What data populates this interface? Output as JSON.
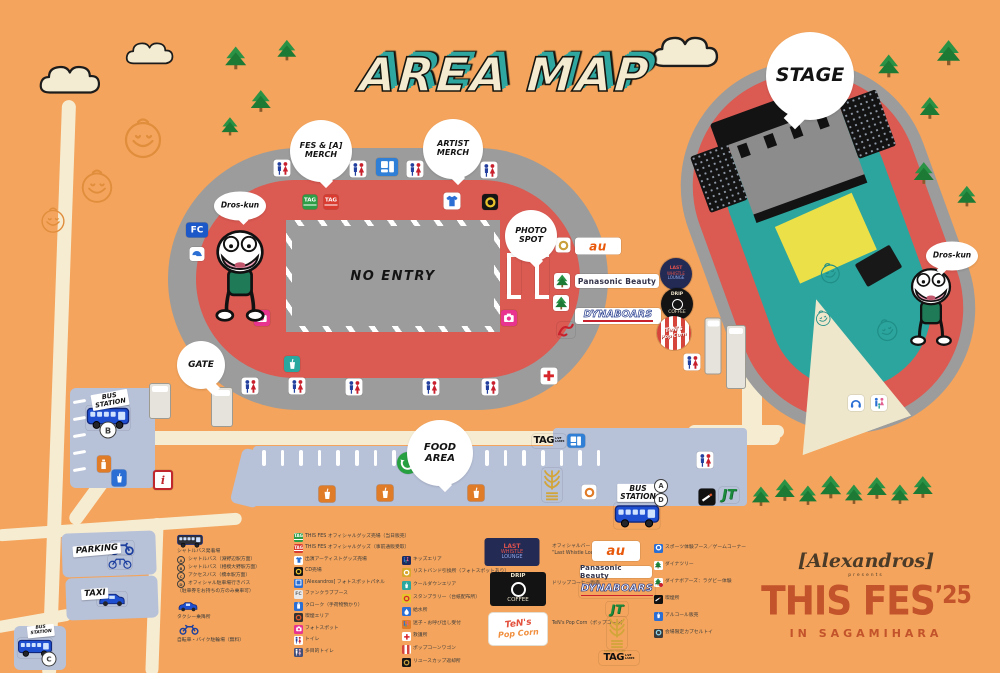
{
  "title": "AREA MAP",
  "colors": {
    "background": "#f4a45c",
    "track_gray": "#9c9c9c",
    "ring_red": "#db5a52",
    "field_teal": "#2ca59e",
    "cream": "#f6ecd2",
    "strip_blue": "#b7c1d8",
    "brand_rust": "#c2532b",
    "title_teal": "#2fa7a0",
    "bus_blue": "#1e4fd0",
    "tree_green": "#1c7a35"
  },
  "brand": {
    "artist": "[Alexandros]",
    "presents": "presents",
    "title": "THIS FES",
    "year": "’25",
    "location": "IN SAGAMIHARA"
  },
  "map": {
    "no_entry": "NO ENTRY",
    "logos": {
      "au": "au",
      "panasonic": "Panasonic Beauty",
      "dynaboars": "DYNABOARS",
      "jt": "JT",
      "fc": "FC",
      "info": "i",
      "tag_main": "TAG",
      "tag_sub": [
        "LIVE",
        "LANES"
      ],
      "tag_mark": "TAG",
      "spring_valley": "SPRING VALLEY"
    },
    "bubbles": [
      {
        "id": "fes-merch",
        "lines": [
          "FES & [A]",
          "MERCH"
        ],
        "x": 321,
        "y": 151,
        "d": 62,
        "fs": 8,
        "tail": "b"
      },
      {
        "id": "artist-merch",
        "lines": [
          "ARTIST",
          "MERCH"
        ],
        "x": 453,
        "y": 149,
        "d": 60,
        "fs": 8,
        "tail": "b"
      },
      {
        "id": "photo-spot",
        "lines": [
          "PHOTO",
          "SPOT"
        ],
        "x": 531,
        "y": 236,
        "d": 52,
        "fs": 8,
        "tail": "b"
      },
      {
        "id": "gate",
        "lines": [
          "GATE"
        ],
        "x": 201,
        "y": 365,
        "d": 48,
        "fs": 9,
        "tail": "br"
      },
      {
        "id": "food-area",
        "lines": [
          "FOOD",
          "AREA"
        ],
        "x": 440,
        "y": 453,
        "d": 66,
        "fs": 10,
        "tail": "b"
      },
      {
        "id": "stage",
        "lines": [
          "STAGE"
        ],
        "x": 810,
        "y": 76,
        "d": 88,
        "fs": 19,
        "tail": "bl"
      },
      {
        "id": "dros-kun-1",
        "lines": [
          "Dros-kun"
        ],
        "x": 240,
        "y": 206,
        "d": 52,
        "fs": 7.5,
        "tail": "b",
        "ell": true
      },
      {
        "id": "dros-kun-2",
        "lines": [
          "Dros-kun"
        ],
        "x": 952,
        "y": 256,
        "d": 52,
        "fs": 7.5,
        "tail": "bl",
        "ell": true
      }
    ],
    "signs": [
      {
        "id": "bus-station-b",
        "lines": [
          "BUS",
          "STATION"
        ],
        "x": 110,
        "y": 400,
        "rot": -10,
        "fs": 6.5
      },
      {
        "id": "bus-station-ad",
        "lines": [
          "BUS",
          "STATION"
        ],
        "x": 638,
        "y": 493,
        "rot": 0,
        "fs": 7.5
      },
      {
        "id": "bus-station-c",
        "lines": [
          "BUS",
          "STATION"
        ],
        "x": 41,
        "y": 631,
        "rot": -6,
        "fs": 4.5
      },
      {
        "id": "parking",
        "lines": [
          "PARKING"
        ],
        "x": 97,
        "y": 550,
        "rot": -5,
        "fs": 8.5
      },
      {
        "id": "taxi",
        "lines": [
          "TAXI"
        ],
        "x": 95,
        "y": 594,
        "rot": -4,
        "fs": 8.5
      }
    ],
    "letters": [
      {
        "l": "B",
        "x": 108,
        "y": 430,
        "d": 15
      },
      {
        "l": "A",
        "x": 661,
        "y": 486,
        "d": 12
      },
      {
        "l": "D",
        "x": 661,
        "y": 500,
        "d": 12
      },
      {
        "l": "C",
        "x": 49,
        "y": 659,
        "d": 13
      }
    ],
    "markers": [
      {
        "t": "wc",
        "x": 282,
        "y": 168
      },
      {
        "t": "wc",
        "x": 358,
        "y": 169
      },
      {
        "t": "wc",
        "x": 415,
        "y": 169
      },
      {
        "t": "wc",
        "x": 489,
        "y": 170
      },
      {
        "t": "bluesign",
        "x": 387,
        "y": 167
      },
      {
        "t": "tagG",
        "x": 310,
        "y": 202
      },
      {
        "t": "tagR",
        "x": 331,
        "y": 202
      },
      {
        "t": "shirt",
        "x": 452,
        "y": 201
      },
      {
        "t": "cd",
        "x": 490,
        "y": 202
      },
      {
        "t": "fc",
        "x": 197,
        "y": 230
      },
      {
        "t": "cap",
        "x": 197,
        "y": 254
      },
      {
        "t": "cam",
        "x": 262,
        "y": 318
      },
      {
        "t": "cam",
        "x": 509,
        "y": 318
      },
      {
        "t": "frame",
        "x": 514,
        "y": 276
      },
      {
        "t": "frame",
        "x": 542,
        "y": 276
      },
      {
        "t": "gold",
        "x": 563,
        "y": 245
      },
      {
        "t": "aubox",
        "x": 598,
        "y": 246
      },
      {
        "t": "treebox",
        "x": 562,
        "y": 281
      },
      {
        "t": "panasonic",
        "x": 617,
        "y": 281
      },
      {
        "t": "treebox",
        "x": 561,
        "y": 303
      },
      {
        "t": "dynaboars",
        "x": 618,
        "y": 316
      },
      {
        "t": "boarsred",
        "x": 566,
        "y": 330
      },
      {
        "t": "tealbox",
        "x": 292,
        "y": 364
      },
      {
        "t": "wc",
        "x": 250,
        "y": 386
      },
      {
        "t": "wc",
        "x": 297,
        "y": 386
      },
      {
        "t": "wc",
        "x": 354,
        "y": 387
      },
      {
        "t": "wc",
        "x": 431,
        "y": 387
      },
      {
        "t": "wc",
        "x": 490,
        "y": 387
      },
      {
        "t": "firstaid",
        "x": 549,
        "y": 376
      },
      {
        "t": "wc",
        "x": 692,
        "y": 362
      },
      {
        "t": "wc",
        "x": 705,
        "y": 460
      },
      {
        "t": "eco",
        "x": 408,
        "y": 463
      },
      {
        "t": "info",
        "x": 163,
        "y": 480
      },
      {
        "t": "vendO",
        "x": 104,
        "y": 464
      },
      {
        "t": "vendB",
        "x": 119,
        "y": 478
      },
      {
        "t": "food",
        "x": 327,
        "y": 494
      },
      {
        "t": "food",
        "x": 385,
        "y": 493
      },
      {
        "t": "food",
        "x": 476,
        "y": 493
      },
      {
        "t": "wheat",
        "x": 552,
        "y": 485
      },
      {
        "t": "ringO",
        "x": 589,
        "y": 492
      },
      {
        "t": "taglogo",
        "x": 549,
        "y": 441
      },
      {
        "t": "bluesign",
        "x": 576,
        "y": 441,
        "s": 0.8
      },
      {
        "t": "smoke",
        "x": 707,
        "y": 497
      },
      {
        "t": "jt",
        "x": 729,
        "y": 495
      },
      {
        "t": "head",
        "x": 856,
        "y": 403
      },
      {
        "t": "fam",
        "x": 879,
        "y": 403
      },
      {
        "t": "bus",
        "x": 108,
        "y": 418
      },
      {
        "t": "bus",
        "x": 35,
        "y": 648,
        "s": 0.8
      },
      {
        "t": "bus",
        "x": 637,
        "y": 516,
        "s": 1.05
      },
      {
        "t": "moto",
        "x": 122,
        "y": 548
      },
      {
        "t": "bike",
        "x": 120,
        "y": 562
      },
      {
        "t": "taxicar",
        "x": 112,
        "y": 599
      },
      {
        "t": "tower",
        "x": 160,
        "y": 401,
        "w": 20,
        "h": 34
      },
      {
        "t": "tower",
        "x": 222,
        "y": 407,
        "w": 20,
        "h": 38
      },
      {
        "t": "tower",
        "x": 713,
        "y": 346,
        "w": 15,
        "h": 55
      },
      {
        "t": "tower",
        "x": 736,
        "y": 357,
        "w": 18,
        "h": 62
      },
      {
        "t": "cLounge",
        "x": 676,
        "y": 274
      },
      {
        "t": "cCoffee",
        "x": 677,
        "y": 304
      },
      {
        "t": "cPopcorn",
        "x": 674,
        "y": 333
      },
      {
        "t": "droskun",
        "x": 240,
        "y": 277
      },
      {
        "t": "droskun",
        "x": 931,
        "y": 308,
        "s": 0.85
      }
    ],
    "trees": [
      {
        "x": 237,
        "y": 60,
        "s": 1.0
      },
      {
        "x": 288,
        "y": 52,
        "s": 0.9
      },
      {
        "x": 262,
        "y": 103,
        "s": 0.95
      },
      {
        "x": 231,
        "y": 128,
        "s": 0.8
      },
      {
        "x": 890,
        "y": 68,
        "s": 1.0
      },
      {
        "x": 950,
        "y": 55,
        "s": 1.1
      },
      {
        "x": 931,
        "y": 110,
        "s": 0.95
      },
      {
        "x": 925,
        "y": 175,
        "s": 0.95
      },
      {
        "x": 968,
        "y": 198,
        "s": 0.9
      },
      {
        "x": 762,
        "y": 498,
        "s": 0.85
      },
      {
        "x": 786,
        "y": 492,
        "s": 0.95
      },
      {
        "x": 809,
        "y": 497,
        "s": 0.85
      },
      {
        "x": 832,
        "y": 489,
        "s": 1.0
      },
      {
        "x": 855,
        "y": 496,
        "s": 0.85
      },
      {
        "x": 878,
        "y": 490,
        "s": 0.95
      },
      {
        "x": 901,
        "y": 496,
        "s": 0.85
      },
      {
        "x": 924,
        "y": 489,
        "s": 0.95
      }
    ],
    "clouds": [
      {
        "x": 78,
        "y": 78,
        "w": 84
      },
      {
        "x": 156,
        "y": 52,
        "w": 66
      },
      {
        "x": 694,
        "y": 50,
        "w": 92
      }
    ],
    "doodles": [
      {
        "x": 143,
        "y": 138,
        "r": 25
      },
      {
        "x": 97,
        "y": 186,
        "r": 21
      },
      {
        "x": 53,
        "y": 220,
        "r": 16
      }
    ],
    "stage_doodles": [
      {
        "x": 118,
        "y": 215,
        "r": 13
      },
      {
        "x": 96,
        "y": 255,
        "r": 10
      },
      {
        "x": 152,
        "y": 288,
        "r": 14
      }
    ]
  },
  "legend": {
    "transport": {
      "lines": [
        {
          "badge": null,
          "text": "シャトルバス発着場"
        },
        {
          "badge": "A",
          "text": "シャトルバス（淵野辺駅方面）"
        },
        {
          "badge": "B",
          "text": "シャトルバス（相模大野駅方面）"
        },
        {
          "badge": "C",
          "text": "アクセスバス（橋本駅方面）"
        },
        {
          "badge": "D",
          "text": "オフィシャル駐車場行きバス"
        },
        {
          "badge": null,
          "text": "（駐車券をお持ちの方のみ乗車可）"
        }
      ],
      "taxi": "タクシー乗降所",
      "bike": "自転車・バイク駐輪場（無料）"
    },
    "col2": [
      {
        "i": "tagG",
        "t": "THIS FES オフィシャルグッズ売場（当日販売）"
      },
      {
        "i": "tagR",
        "t": "THIS FES オフィシャルグッズ（事前通販受取）"
      },
      {
        "i": "shirt",
        "t": "出演アーティストグッズ売場"
      },
      {
        "i": "cd",
        "t": "CD売場"
      },
      {
        "i": "panel",
        "t": "[Alexandros] フォトスポットパネル"
      },
      {
        "i": "fcL",
        "t": "ファンクラブブース"
      },
      {
        "i": "cloak",
        "t": "クローク（手荷物預かり）"
      },
      {
        "i": "smokeC",
        "t": "喫煙エリア"
      },
      {
        "i": "cam",
        "t": "フォトスポット"
      },
      {
        "i": "wc",
        "t": "トイレ"
      },
      {
        "i": "wcD",
        "t": "多目的トイレ"
      }
    ],
    "col3": [
      {
        "i": "kids",
        "t": "キッズエリア"
      },
      {
        "i": "wrist",
        "t": "リストバンド引換所（フォトスポットあり）"
      },
      {
        "i": "cool",
        "t": "クールダウンエリア"
      },
      {
        "i": "stamp",
        "t": "スタンプラリー（台紙配布所）"
      },
      {
        "i": "water",
        "t": "給水所"
      },
      {
        "i": "lost",
        "t": "迷子・お呼び出し受付"
      },
      {
        "i": "cross",
        "t": "救護所"
      },
      {
        "i": "stripe",
        "t": "ポップコーンワゴン"
      },
      {
        "i": "coin",
        "t": "リユースカップ返却所"
      }
    ],
    "col6": [
      {
        "i": "sport",
        "t": "スポーツ体験ブース／ゲームコーナー"
      },
      {
        "i": "treeB",
        "t": "ダイナツリー"
      },
      {
        "i": "treeR",
        "t": "ダイナボアーズ：ラグビー体験"
      },
      {
        "i": "smoke",
        "t": "喫煙所"
      },
      {
        "i": "drink",
        "t": "アルコール販売"
      },
      {
        "i": "gacha",
        "t": "会場限定カプセルトイ"
      }
    ],
    "vendors": [
      {
        "lines": [
          "LAST",
          "WHISTLE",
          "LOUNGE"
        ],
        "desc": [
          "オフィシャルバー",
          "“Last Whistle Lounge”"
        ]
      },
      {
        "lines": [
          "DRIP",
          "COFFEE"
        ],
        "desc": [
          "ドリップコーヒー販売"
        ]
      },
      {
        "lines": [
          "TeN's",
          "Pop Corn"
        ],
        "desc": [
          "TeN's Pop Corn（ポップコーン）"
        ]
      }
    ]
  }
}
